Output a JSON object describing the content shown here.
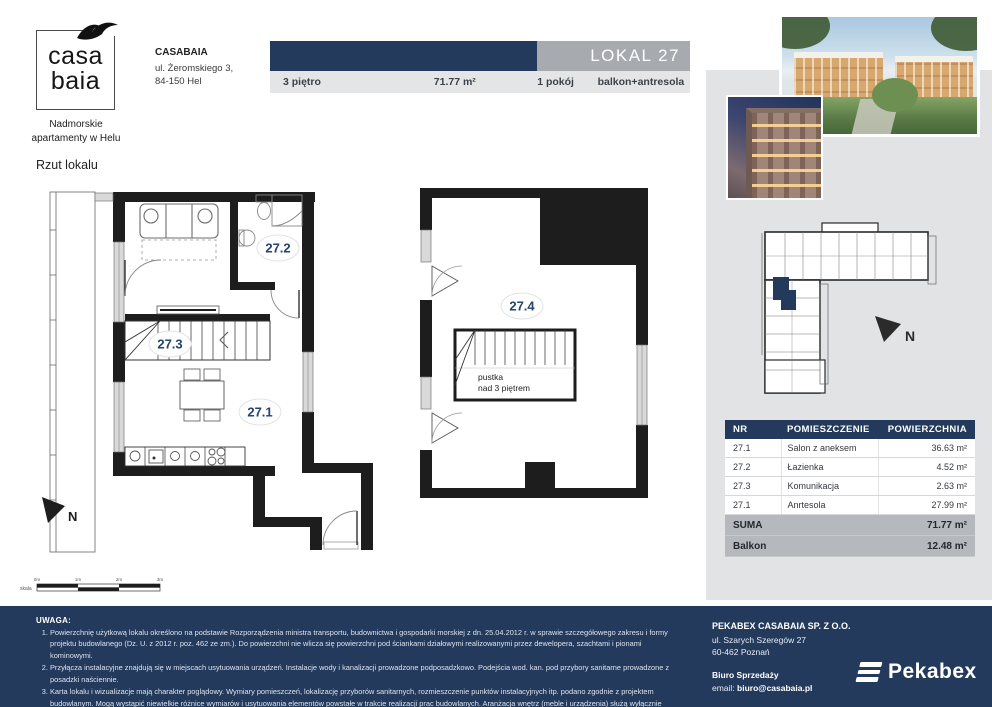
{
  "branding": {
    "logo_word1": "casa",
    "logo_word2": "baia",
    "tagline1": "Nadmorskie",
    "tagline2": "apartamenty w Helu"
  },
  "header": {
    "company_name": "CASABAIA",
    "company_address1": "ul. Żeromskiego 3,",
    "company_address2": "84-150 Hel",
    "unit_title": "LOKAL 27",
    "floor": "3 piętro",
    "total_area": "71.77 m²",
    "rooms": "1 pokój",
    "extras": "balkon+antresola"
  },
  "plan": {
    "section_title": "Rzut lokalu",
    "labels": {
      "salon": "27.1",
      "lazienka": "27.2",
      "komunikacja": "27.3",
      "antresola": "27.4"
    },
    "void_note1": "pustka",
    "void_note2": "nad 3 piętrem",
    "north": "N",
    "scale": {
      "label": "skala",
      "ticks": [
        "0m",
        "1m",
        "2m",
        "3m"
      ]
    }
  },
  "site": {
    "north": "N"
  },
  "rooms_table": {
    "col_nr": "NR",
    "col_name": "POMIESZCZENIE",
    "col_area": "POWIERZCHNIA",
    "rows": [
      {
        "nr": "27.1",
        "name": "Salon z aneksem",
        "area": "36.63 m²"
      },
      {
        "nr": "27.2",
        "name": "Łazienka",
        "area": "4.52 m²"
      },
      {
        "nr": "27.3",
        "name": "Komunikacja",
        "area": "2.63 m²"
      },
      {
        "nr": "27.1",
        "name": "Anrtesola",
        "area": "27.99 m²"
      }
    ],
    "suma_label": "SUMA",
    "suma_value": "71.77 m²",
    "balkon_label": "Balkon",
    "balkon_value": "12.48 m²"
  },
  "footer": {
    "notes_title": "UWAGA:",
    "notes": [
      "Powierzchnię użytkową lokalu określono na podstawie Rozporządzenia ministra transportu, budownictwa i gospodarki morskiej z dn. 25.04.2012 r. w sprawie szczegółowego zakresu i formy projektu budowlanego (Dz. U. z 2012 r. poz. 462 ze zm.). Do powierzchni nie wlicza się powierzchni pod ściankami działowymi realizowanymi przez dewelopera, szachtami i pionami kominowymi.",
      "Przyłącza instalacyjne znajdują się w miejscach usytuowania urządzeń. Instalacje wody i kanalizacji prowadzone podposadzkowo. Podejścia wod. kan. pod przybory sanitarne prowadzone z posadzki naściennie.",
      "Karta lokalu i wizualizacje mają charakter poglądowy. Wymiary pomieszczeń, lokalizację przyborów sanitarnych, rozmieszczenie punktów instalacyjnych itp. podano zgodnie z projektem budowlanym. Mogą wystąpić niewielkie różnice wymiarów i usytuowania elementów powstałe w trakcie realizacji prac budowlanych. Aranżacja wnętrz (meble i urządzenia) służą wyłącznie celom ilustracyjnym."
    ],
    "developer_name": "PEKABEX CASABAIA SP. Z O.O.",
    "developer_address1": "ul. Szarych Szeregów 27",
    "developer_address2": "60-462 Poznań",
    "sales_office_label": "Biuro Sprzedaży",
    "email_prefix": "email: ",
    "email": "biuro@casabaia.pl",
    "brand_name": "Pekabex"
  },
  "colors": {
    "navy": "#233a5c",
    "panel_gray": "#e2e3e5",
    "bar_gray": "#a7aaae",
    "summary_gray": "#b5b8bc"
  }
}
